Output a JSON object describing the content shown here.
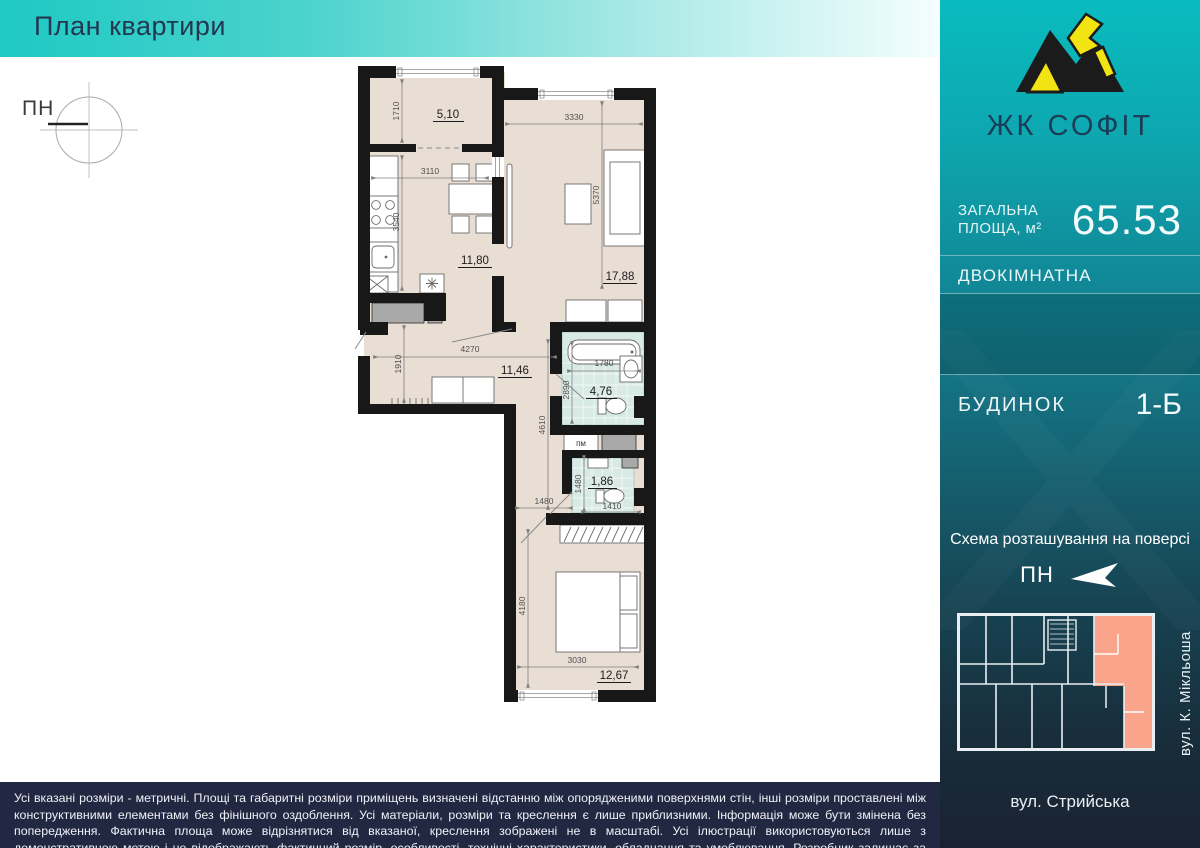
{
  "title": "План квартири",
  "compass": {
    "label": "ПН"
  },
  "plan": {
    "areas": {
      "balcony": "5,10",
      "kitchen": "11,80",
      "living": "17,88",
      "hall": "11,46",
      "bath": "4,76",
      "wc": "1,86",
      "bedroom": "12,67"
    },
    "dims": {
      "balcony_height": "1710",
      "kitchen_width": "3110",
      "kitchen_height": "3540",
      "living_width": "3330",
      "living_height": "5370",
      "hall_width": "4270",
      "hall_height": "1910",
      "corridor_height": "4610",
      "bath_width": "1780",
      "bath_height": "2890",
      "wc_height": "1480",
      "wc_width": "1410",
      "corridor_width": "1480",
      "bedroom_height": "4180",
      "bedroom_width": "3030"
    },
    "labels": {
      "washing_machine": "пм"
    }
  },
  "sidebar": {
    "brand": "ЖК СОФІТ",
    "total_area": {
      "label_line1": "ЗАГАЛЬНА",
      "label_line2": "ПЛОЩА, м²",
      "value": "65.53"
    },
    "apartment_type": "ДВОКІМНАТНА",
    "building": {
      "label": "БУДИНОК",
      "value": "1-Б"
    },
    "schema": {
      "title": "Схема розташування на поверсі",
      "north_label": "ПН",
      "street_side": "вул. К. Мікльоша",
      "street_bottom": "вул. Стрийська"
    }
  },
  "footer": {
    "disclaimer": "Усі вказані розміри - метричні. Площі та габаритні розміри приміщень визначені відстанню між опорядженими поверхнями стін, інші розміри проставлені між конструктивними елементами без фінішного оздоблення. Усі матеріали, розміри та креслення є лише приблизними. Інформація може бути змінена без попередження. Фактична площа може відрізнятися від вказаної, креслення зображені не в масштабі. Усі ілюстрації використовуються лише з демонстративною метою і не відображають фактичний розмір, особливості, технічні характеристики, обладнання та умеблювання. Розробник залишає за собою на власний розсуд вносити зміни та корективи без будь-якої юридичної відповідальності."
  },
  "colors": {
    "accent_teal": "#09bcbf",
    "highlight_salmon": "#f9a48b",
    "wall_black": "#181818",
    "room_beige": "#e9ded4",
    "tile_teal": "#d8eae4"
  }
}
